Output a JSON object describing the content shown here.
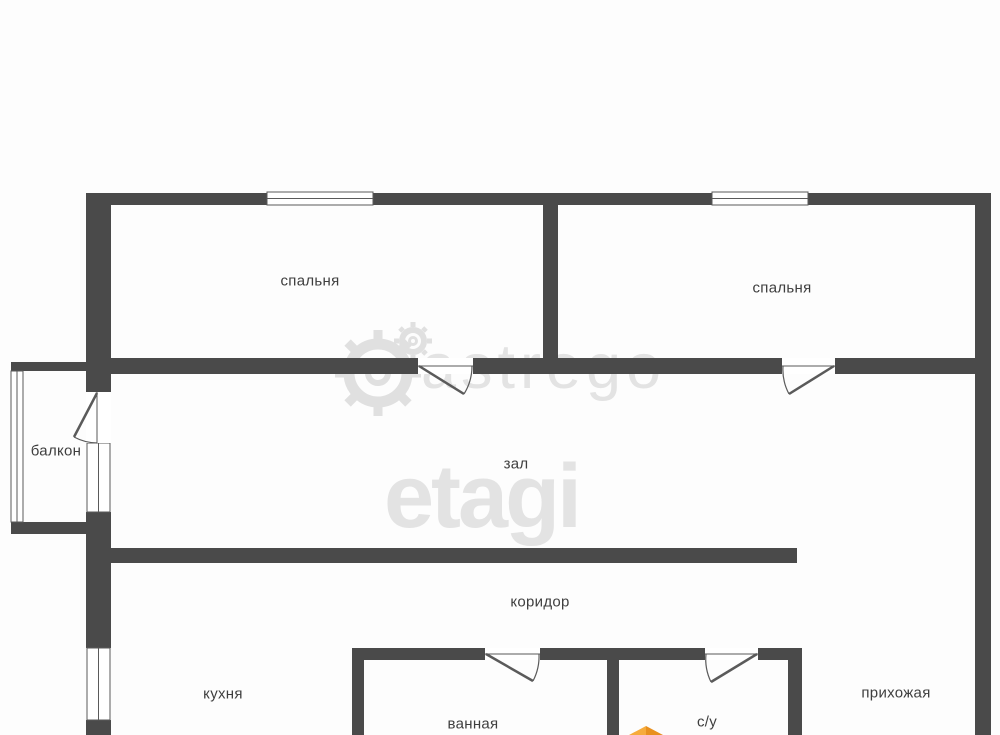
{
  "rooms": {
    "bedroom1": "спальня",
    "bedroom2": "спальня",
    "balcony": "балкон",
    "hall": "зал",
    "corridor": "коридор",
    "kitchen": "кухня",
    "bathroom": "ванная",
    "wc": "с/у",
    "entry": "прихожая"
  },
  "watermark": {
    "brand": "etagi",
    "agency": "astrego"
  },
  "colors": {
    "background": "#fdfdfd",
    "wall": "#4a4a4a",
    "line": "#5a5a5a",
    "label": "#3e3e3e",
    "watermark": "#e3e3e3",
    "watermark2": "#e0e0e0",
    "logolight": "#f6ab3c",
    "logodark": "#e8901f"
  }
}
